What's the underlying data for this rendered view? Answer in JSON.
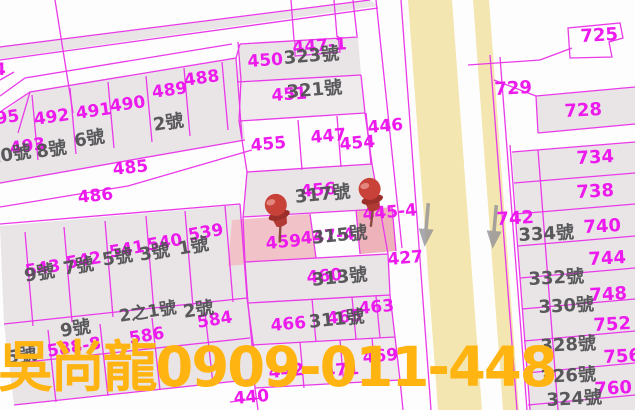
{
  "watermark": {
    "text": "吳尚龍0909-011-448",
    "color": "#ffb412"
  },
  "map": {
    "colors": {
      "line": "#e93ae9",
      "parcel_text": "#ed1aed",
      "house_text": "#4f4f52",
      "parcel_fill": "#e9e5e7",
      "road_fill": "#f4e6b0",
      "highlight_fill": "#f2c2c9",
      "highlight_fill_strong": "#eeb2bb",
      "pin_red": "#c0453c",
      "arrow_gray": "#8c8c94"
    },
    "parcel_labels": [
      {
        "t": "4",
        "x": -6,
        "y": 62,
        "r": 0
      },
      {
        "t": "495",
        "x": -17,
        "y": 113,
        "r": -8
      },
      {
        "t": "493",
        "x": 9,
        "y": 141,
        "r": -8
      },
      {
        "t": "492",
        "x": 33,
        "y": 112,
        "r": -8
      },
      {
        "t": "491",
        "x": 75,
        "y": 106,
        "r": -8
      },
      {
        "t": "490",
        "x": 109,
        "y": 99,
        "r": -8
      },
      {
        "t": "489",
        "x": 151,
        "y": 85,
        "r": -8
      },
      {
        "t": "488",
        "x": 183,
        "y": 73,
        "r": -8
      },
      {
        "t": "485",
        "x": 112,
        "y": 162,
        "r": -6
      },
      {
        "t": "486",
        "x": 77,
        "y": 190,
        "r": -6
      },
      {
        "t": "450",
        "x": 247,
        "y": 54,
        "r": -4
      },
      {
        "t": "447-1",
        "x": 292,
        "y": 40,
        "r": -4
      },
      {
        "t": "451",
        "x": 271,
        "y": 88,
        "r": -4
      },
      {
        "t": "455",
        "x": 250,
        "y": 138,
        "r": -5
      },
      {
        "t": "447",
        "x": 310,
        "y": 130,
        "r": -5
      },
      {
        "t": "454",
        "x": 339,
        "y": 137,
        "r": -5
      },
      {
        "t": "446",
        "x": 367,
        "y": 120,
        "r": -5
      },
      {
        "t": "456",
        "x": 300,
        "y": 184,
        "r": -5
      },
      {
        "t": "459",
        "x": 265,
        "y": 236,
        "r": -5
      },
      {
        "t": "447-4",
        "x": 300,
        "y": 231,
        "r": -5
      },
      {
        "t": "445-4",
        "x": 362,
        "y": 207,
        "r": -5
      },
      {
        "t": "427",
        "x": 387,
        "y": 252,
        "r": -5
      },
      {
        "t": "460",
        "x": 306,
        "y": 270,
        "r": -5
      },
      {
        "t": "463",
        "x": 358,
        "y": 301,
        "r": -5
      },
      {
        "t": "465",
        "x": 326,
        "y": 311,
        "r": -5
      },
      {
        "t": "466",
        "x": 270,
        "y": 318,
        "r": -5
      },
      {
        "t": "469",
        "x": 362,
        "y": 350,
        "r": -5
      },
      {
        "t": "442",
        "x": 268,
        "y": 365,
        "r": -5
      },
      {
        "t": "471",
        "x": 323,
        "y": 364,
        "r": -5
      },
      {
        "t": "440",
        "x": 233,
        "y": 391,
        "r": -5
      },
      {
        "t": "539",
        "x": 187,
        "y": 228,
        "r": -10
      },
      {
        "t": "540",
        "x": 146,
        "y": 238,
        "r": -10
      },
      {
        "t": "541",
        "x": 108,
        "y": 245,
        "r": -10
      },
      {
        "t": "542",
        "x": 65,
        "y": 256,
        "r": -10
      },
      {
        "t": "543",
        "x": 24,
        "y": 264,
        "r": -10
      },
      {
        "t": "584",
        "x": 196,
        "y": 315,
        "r": -9
      },
      {
        "t": "586",
        "x": 128,
        "y": 331,
        "r": -9
      },
      {
        "t": "588-8",
        "x": 46,
        "y": 344,
        "r": -9
      },
      {
        "t": "725",
        "x": 580,
        "y": 28,
        "r": -3,
        "fs": 18
      },
      {
        "t": "729",
        "x": 494,
        "y": 81,
        "r": -3,
        "fs": 18
      },
      {
        "t": "728",
        "x": 564,
        "y": 103,
        "r": -3,
        "fs": 18
      },
      {
        "t": "734",
        "x": 576,
        "y": 150,
        "r": -3,
        "fs": 18
      },
      {
        "t": "738",
        "x": 576,
        "y": 184,
        "r": -3,
        "fs": 18
      },
      {
        "t": "742",
        "x": 496,
        "y": 211,
        "r": -3,
        "fs": 18
      },
      {
        "t": "740",
        "x": 583,
        "y": 219,
        "r": -3,
        "fs": 18
      },
      {
        "t": "744",
        "x": 588,
        "y": 251,
        "r": -3,
        "fs": 18
      },
      {
        "t": "748",
        "x": 589,
        "y": 287,
        "r": -3,
        "fs": 18
      },
      {
        "t": "752",
        "x": 593,
        "y": 317,
        "r": -3,
        "fs": 18
      },
      {
        "t": "756",
        "x": 603,
        "y": 349,
        "r": -3,
        "fs": 18
      },
      {
        "t": "760",
        "x": 594,
        "y": 381,
        "r": -3,
        "fs": 18
      }
    ],
    "house_labels": [
      {
        "t": "10號",
        "x": -13,
        "y": 150,
        "r": -9
      },
      {
        "t": "8號",
        "x": 35,
        "y": 144,
        "r": -9
      },
      {
        "t": "6號",
        "x": 73,
        "y": 133,
        "r": -9
      },
      {
        "t": "2號",
        "x": 152,
        "y": 117,
        "r": -9
      },
      {
        "t": "323號",
        "x": 283,
        "y": 50,
        "r": -5
      },
      {
        "t": "321號",
        "x": 286,
        "y": 84,
        "r": -5
      },
      {
        "t": "317號",
        "x": 294,
        "y": 189,
        "r": -6
      },
      {
        "t": "315號",
        "x": 311,
        "y": 230,
        "r": -6
      },
      {
        "t": "313號",
        "x": 311,
        "y": 272,
        "r": -6
      },
      {
        "t": "311號",
        "x": 308,
        "y": 314,
        "r": -6
      },
      {
        "t": "1號",
        "x": 177,
        "y": 241,
        "r": -10
      },
      {
        "t": "3號",
        "x": 138,
        "y": 247,
        "r": -10
      },
      {
        "t": "5號",
        "x": 101,
        "y": 252,
        "r": -10
      },
      {
        "t": "7號",
        "x": 62,
        "y": 261,
        "r": -10
      },
      {
        "t": "9號",
        "x": 23,
        "y": 268,
        "r": -10
      },
      {
        "t": "9號",
        "x": 59,
        "y": 323,
        "r": -9
      },
      {
        "t": "2之1號",
        "x": 118,
        "y": 309,
        "r": -9,
        "fs": 17
      },
      {
        "t": "2號",
        "x": 182,
        "y": 304,
        "r": -9
      },
      {
        "t": "5號",
        "x": 5,
        "y": 350,
        "r": -9
      },
      {
        "t": "334號",
        "x": 518,
        "y": 227,
        "r": -3
      },
      {
        "t": "332號",
        "x": 528,
        "y": 271,
        "r": -3
      },
      {
        "t": "330號",
        "x": 538,
        "y": 299,
        "r": -3
      },
      {
        "t": "328號",
        "x": 540,
        "y": 338,
        "r": -3
      },
      {
        "t": "326號",
        "x": 540,
        "y": 369,
        "r": -3
      },
      {
        "t": "324號",
        "x": 546,
        "y": 392,
        "r": -3
      }
    ],
    "pins": [
      {
        "x": 258,
        "y": 192,
        "r": -18
      },
      {
        "x": 352,
        "y": 176,
        "r": -14
      }
    ],
    "road_arrows": [
      {
        "x": 419,
        "y": 203,
        "r": 5
      },
      {
        "x": 487,
        "y": 205,
        "r": 5
      }
    ]
  }
}
